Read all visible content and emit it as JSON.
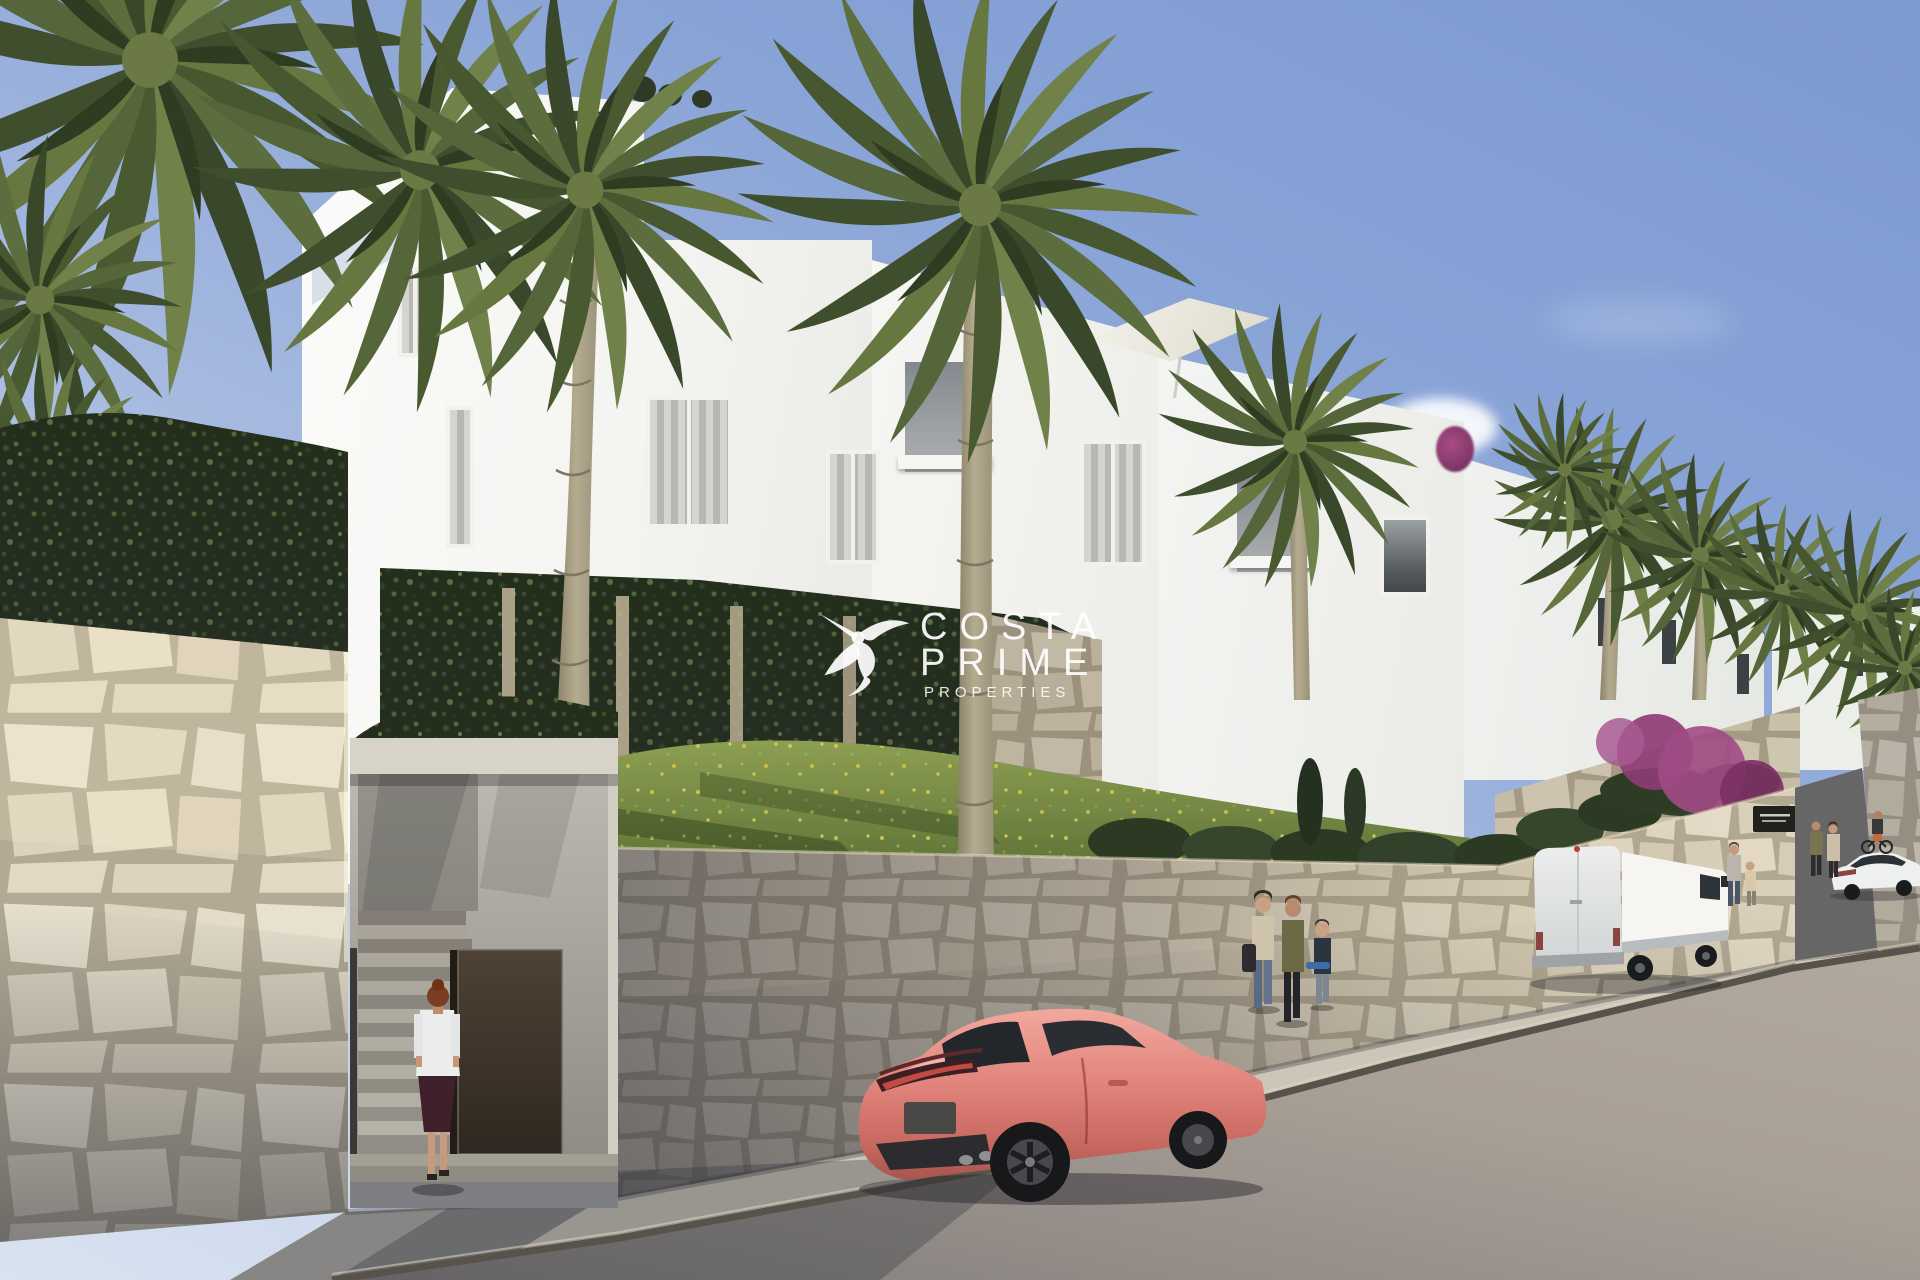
{
  "watermark": {
    "logo_icon": "hummingbird-icon",
    "line1": "COSTA",
    "line2": "PRIME",
    "line3": "PROPERTIES",
    "color": "#ffffff"
  },
  "palette": {
    "sky_top": "#7c99d0",
    "sky_horizon": "#d9e2f0",
    "building_white": "#f6f6f3",
    "stone_wall_sunlit": "#e7e0cd",
    "stone_wall_shadow": "#8a867f",
    "ivy_green": "#2c3a22",
    "grass_green": "#77904a",
    "flower_yellow": "#d6c94e",
    "bougainvillea_magenta": "#a14b85",
    "sports_car_pink": "#e0837b",
    "van_white": "#f0f1ef",
    "road_gray": "#a59d93",
    "door_brown": "#42362a"
  }
}
